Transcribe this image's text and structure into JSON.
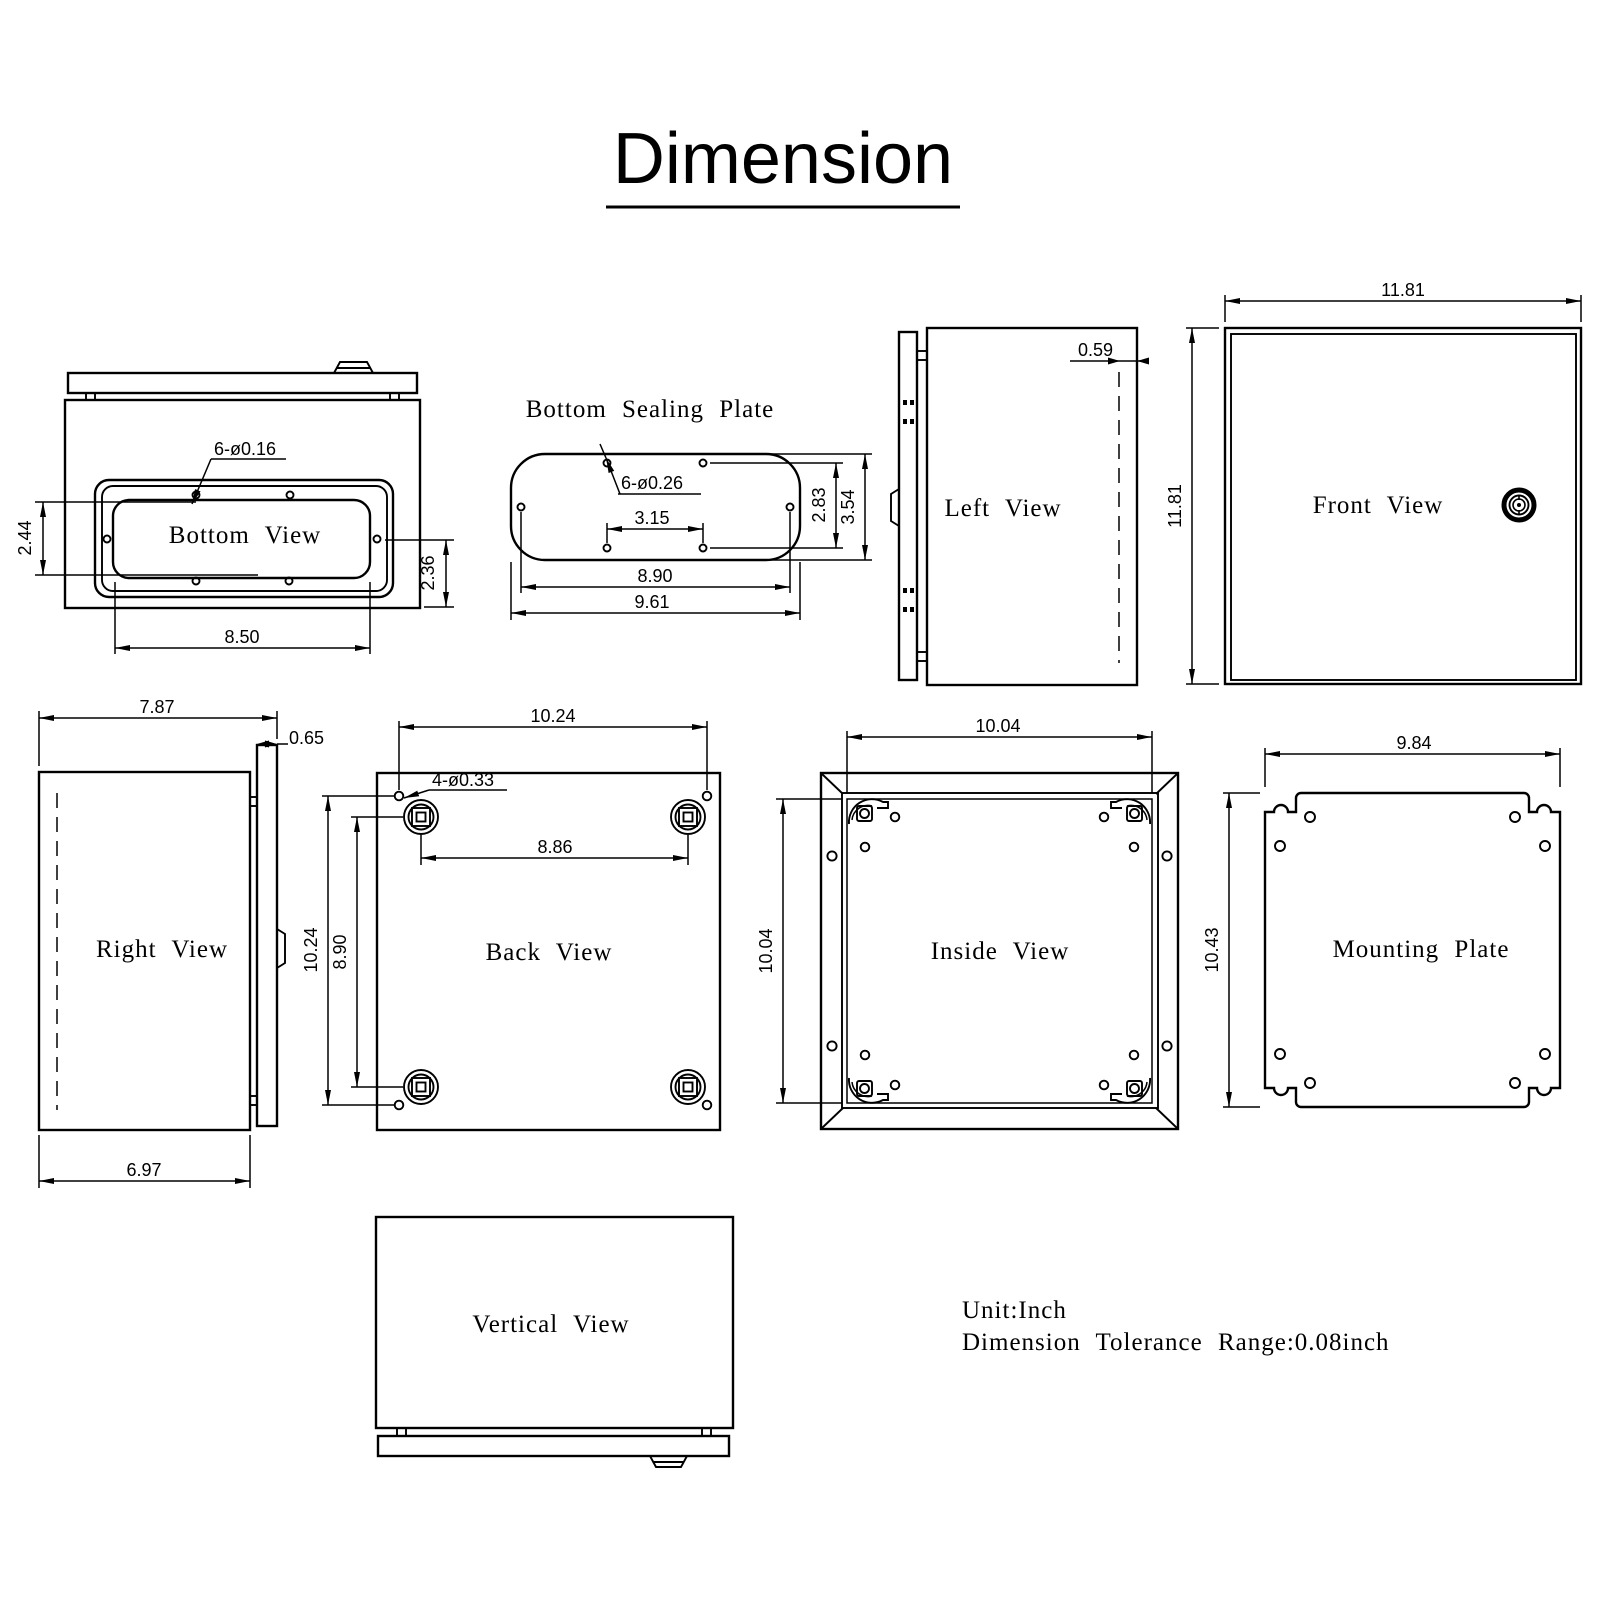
{
  "title": {
    "text": "Dimension"
  },
  "notes": {
    "unit": "Unit:Inch",
    "tolerance": "Dimension Tolerance Range:0.08inch"
  },
  "colors": {
    "line": "#000000",
    "background": "#ffffff"
  },
  "views": {
    "bottom": {
      "label": "Bottom View",
      "hole_callout": "6-ø0.16",
      "dim_left": "2.44",
      "dim_right": "2.36",
      "dim_width": "8.50"
    },
    "sealing_plate": {
      "label": "Bottom Sealing Plate",
      "hole_callout": "6-ø0.26",
      "dim_inner_span": "3.15",
      "dim_hole_span": "8.90",
      "dim_width": "9.61",
      "dim_hole_height": "2.83",
      "dim_height": "3.54"
    },
    "left": {
      "label": "Left View",
      "dim_door_inset": "0.59"
    },
    "front": {
      "label": "Front View",
      "dim_width": "11.81",
      "dim_height": "11.81"
    },
    "right": {
      "label": "Right View",
      "dim_depth_total": "7.87",
      "dim_door_thickness": "0.65",
      "dim_depth_body": "6.97"
    },
    "back": {
      "label": "Back View",
      "dim_hole_span_h": "10.24",
      "hole_callout": "4-ø0.33",
      "dim_mount_span_h": "8.86",
      "dim_hole_span_v": "10.24",
      "dim_mount_span_v": "8.90"
    },
    "inside": {
      "label": "Inside View",
      "dim_width": "10.04",
      "dim_height": "10.04"
    },
    "mounting_plate": {
      "label": "Mounting Plate",
      "dim_width": "9.84",
      "dim_height": "10.43"
    },
    "vertical": {
      "label": "Vertical View"
    }
  }
}
